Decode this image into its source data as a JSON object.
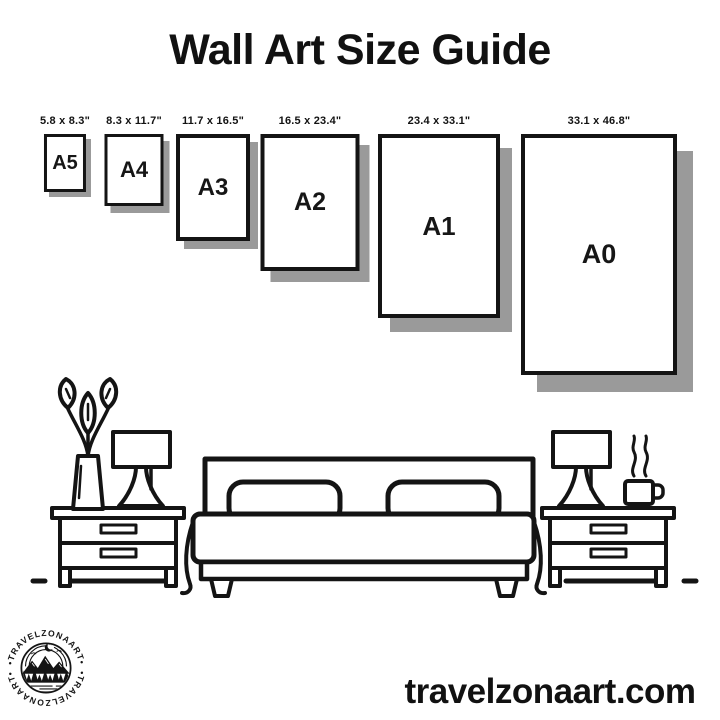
{
  "title": "Wall Art Size Guide",
  "frames": [
    {
      "name": "A5",
      "dimensions": "5.8 x 8.3\""
    },
    {
      "name": "A4",
      "dimensions": "8.3 x 11.7\""
    },
    {
      "name": "A3",
      "dimensions": "11.7 x 16.5\""
    },
    {
      "name": "A2",
      "dimensions": "16.5 x 23.4\""
    },
    {
      "name": "A1",
      "dimensions": "23.4 x 33.1\""
    },
    {
      "name": "A0",
      "dimensions": "33.1 x 46.8\""
    }
  ],
  "logo": {
    "arc_text_top": "•TRAVELZONAART•",
    "arc_text_bottom": "•TRAVELZONAART•"
  },
  "footer": {
    "website": "travelzonaart.com"
  },
  "colors": {
    "background": "#ffffff",
    "ink": "#141414",
    "shadow": "#9a9a9a"
  }
}
